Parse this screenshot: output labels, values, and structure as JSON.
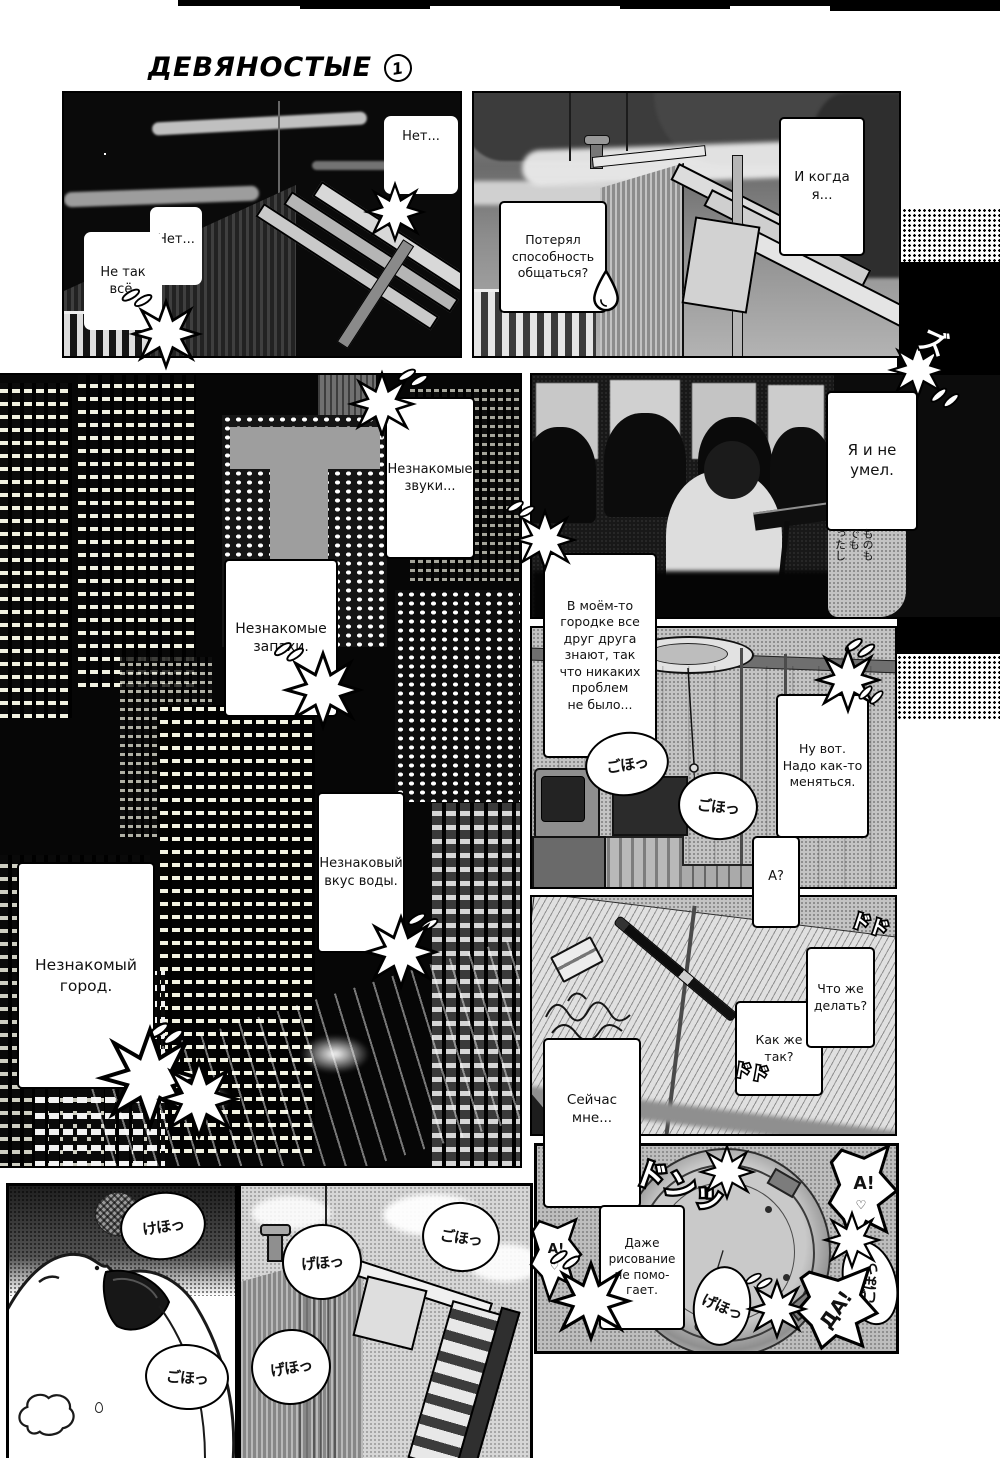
{
  "page": {
    "title": "ДЕВЯНОСТЫЕ",
    "chapter": "1"
  },
  "p1": {
    "net_right": "Нет...",
    "net_left": "Нет...",
    "ne_tak": "Не так\nвсё."
  },
  "p2": {
    "poteryal": "Потерял\nспособность\nобщаться?",
    "i_kogda": "И когда\nя..."
  },
  "p3": {
    "zvuki": "Незнакомые\nзвуки...",
    "zapahi": "Незнакомые\nзапахи.",
    "vkus": "Незнаковый\nвкус воды.",
    "gorod": "Незнакомый\nгород."
  },
  "p4": {
    "ya_i_ne": "Я и не\nумел.",
    "v_moyom": "В моём-то\nгородке все\nдруг друга\nзнают, так\nчто никаких\nпроблем\nне было...",
    "jp_margin": "ものも\nでも\nったし"
  },
  "p5": {
    "nu_vot": "Ну вот.\nНадо как-то\nменяться.",
    "a_q": "А?",
    "goho": "ごほっ"
  },
  "p6": {
    "chto_zhe": "Что же\nделать?",
    "kak_zhe": "Как же\nтак?",
    "seychas": "Сейчас\nмне..."
  },
  "p7": {
    "dazhe": "Даже\nрисование\nне помо-\nгает.",
    "a1": "А!",
    "a2": "А!",
    "da": "ДА!",
    "heart": "♡",
    "goho": "ごほっ",
    "geho": "げほっ"
  },
  "p8": {
    "keho": "けほっ",
    "goho": "ごほっ"
  },
  "p9": {
    "goho": "ごほっ",
    "geho": "げほっ"
  },
  "sfx": {
    "don": "ドンッ",
    "zu": "ズ",
    "dodo": "ドド"
  }
}
